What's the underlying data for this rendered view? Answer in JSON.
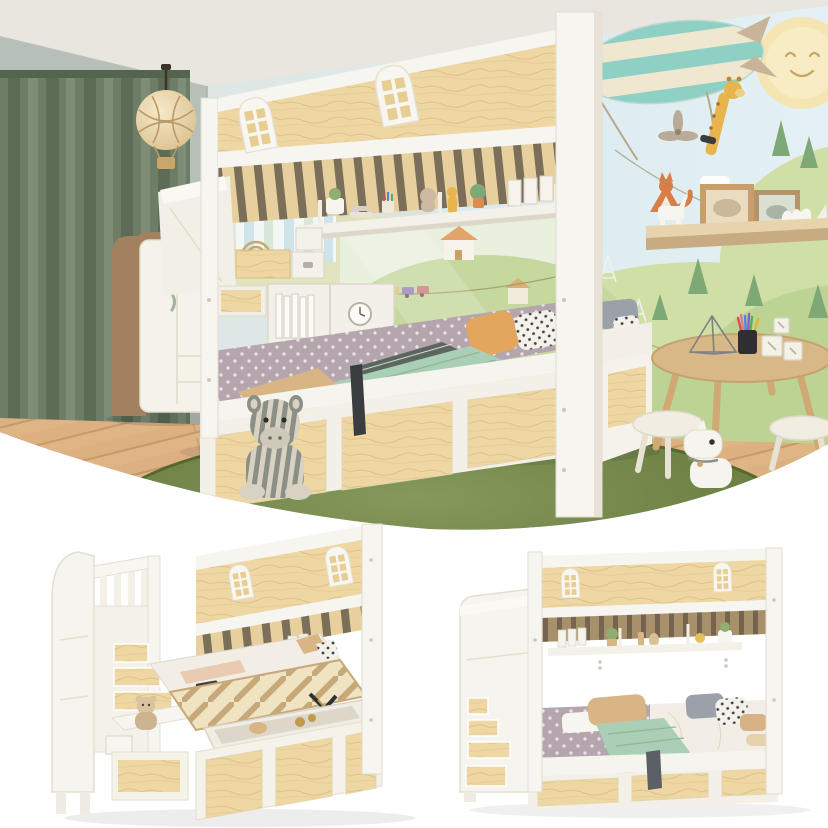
{
  "meta": {
    "title": "Kids house bunk bed — lifestyle photo and product renders collage",
    "text_in_image": "none",
    "layout": "top lifestyle photo with curved white bottom edge; two product renders on white below"
  },
  "palette": {
    "ceiling": "#e9e6e0",
    "wall_left": "#b6c0b9",
    "mural_sky": "#dcecf1",
    "mural_hill_light": "#cfdfa6",
    "mural_hill": "#bdd394",
    "mural_tree": "#7fa877",
    "mural_sun": "#f4e5b2",
    "airship_teal": "#8fd0c5",
    "airship_cream": "#efe7cf",
    "giraffe_yellow": "#e7b44e",
    "curtain_green": "#6e7e66",
    "floor_oak": "#ddb082",
    "rug_olive": "#64783c",
    "pine_wood": "#eed7a2",
    "frame_white": "#f6f4ee",
    "sheet_mauve": "#b5a5ad",
    "blanket_mint": "#abceb6",
    "pillow_orange": "#e2a65c",
    "pillow_tan": "#d9b586",
    "pillow_dark": "#4b5157",
    "wardrobe_walnut": "#a3815f",
    "table_wood": "#d9b887",
    "lift_strap_black": "#3a3d3f",
    "fox_orange": "#d97f45"
  },
  "photo": {
    "label": "Kids bedroom with white-and-pine house bunk bed, storage staircase, mural wall",
    "objects": [
      {
        "name": "curtain",
        "desc": "floor-length sage green curtain"
      },
      {
        "name": "pendant-lamp",
        "desc": "round fabric pendant with rope net and hot-air-balloon basket"
      },
      {
        "name": "wardrobe",
        "desc": "white wardrobe with rounded walnut side and two small drawers"
      },
      {
        "name": "wall-mural",
        "desc": "smiling sun, teal airship with giraffe, green hills, pine trees, fox, clouds"
      },
      {
        "name": "wall-shelf",
        "desc": "wood picture ledge with two frames, paper unicorn, paper camel, origami bird"
      },
      {
        "name": "bunk-bed",
        "desc": "house bunk bed with two arched window cutouts, hanging shelf, storage staircase, lower bed, pine drawer base"
      },
      {
        "name": "hanging-shelf-items",
        "desc": "plant pot, books, pencil cup, bunny and giraffe toys, potted plant, white binders"
      },
      {
        "name": "staircase-storage",
        "desc": "pine boxes, white clasp boxes, cubby with books and alarm clock"
      },
      {
        "name": "bedding",
        "desc": "mauve dotted sheet, mint blanket, striped runner, orange tan gray and polka-dot pillows"
      },
      {
        "name": "rug",
        "desc": "large round olive green rug"
      },
      {
        "name": "zebra-plush",
        "desc": "striped zebra soft toy sitting on rug"
      },
      {
        "name": "kids-table",
        "desc": "round wooden play table with color pencils in black cup, wire pyramid, letter cubes"
      },
      {
        "name": "stools",
        "desc": "two white round stools"
      },
      {
        "name": "horse-toy",
        "desc": "white ride-on horse toy"
      }
    ]
  },
  "renders": {
    "left": {
      "label": "Three-quarter product render: lift-up slatted bed open over storage box",
      "features": [
        "storage staircase with teddy bear shelf",
        "gas-strut lift mechanism",
        "open storage tub",
        "three pine drawers",
        "arched window headboard"
      ]
    },
    "right": {
      "label": "Front product render: made lower bed with staircase storage",
      "features": [
        "staircase with pine step drawers",
        "hanging shelf with binders and plants",
        "made bed with pillows and mint blanket",
        "pull strap",
        "three pine drawers"
      ]
    }
  }
}
